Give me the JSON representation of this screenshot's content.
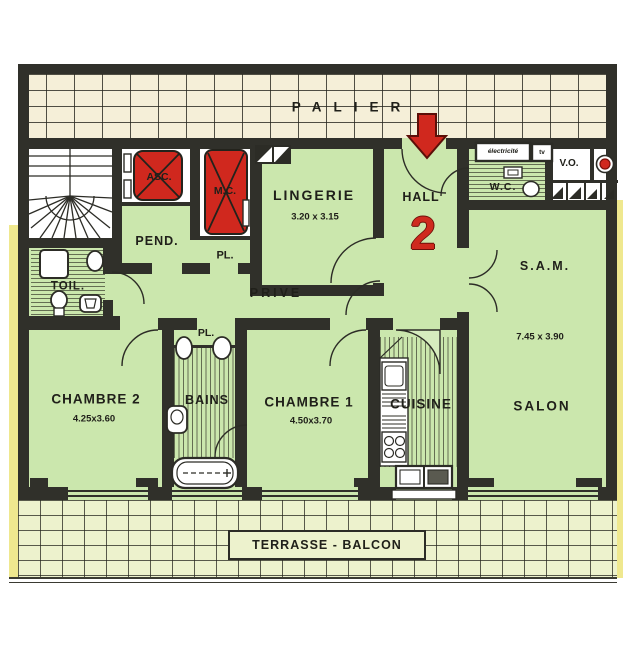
{
  "plan": {
    "landing_label": "PALIER",
    "unit_number": "2",
    "terrace_label": "TERRASSE - BALCON",
    "rooms": {
      "hall": {
        "label": "HALL"
      },
      "lingerie": {
        "label": "LINGERIE",
        "dims": "3.20 x 3.15"
      },
      "sam": {
        "label": "S.A.M.",
        "dims": "7.45 x 3.90"
      },
      "salon": {
        "label": "SALON"
      },
      "cuisine": {
        "label": "CUISINE"
      },
      "chambre1": {
        "label": "CHAMBRE 1",
        "dims": "4.50x3.70"
      },
      "chambre2": {
        "label": "CHAMBRE 2",
        "dims": "4.25x3.60"
      },
      "bains": {
        "label": "BAINS"
      },
      "toil": {
        "label": "TOIL."
      },
      "wc": {
        "label": "W.C."
      },
      "pend": {
        "label": "PEND."
      },
      "prive": {
        "label": "PRIVE"
      },
      "vo": {
        "label": "V.O."
      },
      "asc": {
        "label": "ASC."
      },
      "mc": {
        "label": "M.C."
      },
      "pl_upper": {
        "label": "PL."
      },
      "pl_bains": {
        "label": "PL."
      }
    },
    "annotations": {
      "electricity": "électricité",
      "tv": "tv"
    },
    "colors": {
      "room_green": "#cbe7ad",
      "wall": "#30302a",
      "red": "#d0281e",
      "palier_cream": "#f5efd8",
      "terrace": "#edf2cd",
      "yellow_edge": "#efe88f"
    }
  }
}
